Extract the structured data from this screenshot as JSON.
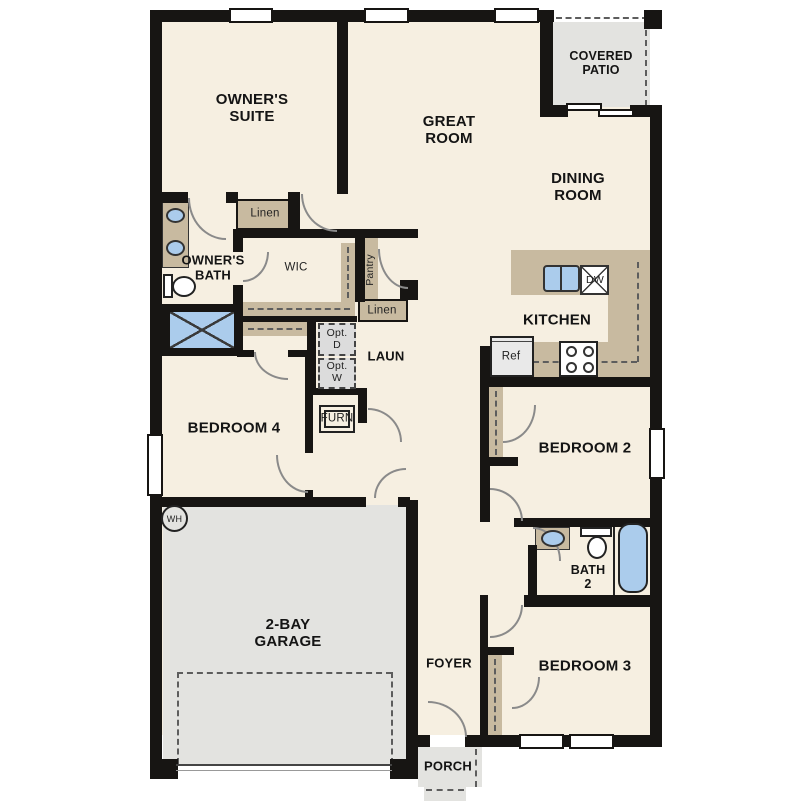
{
  "floorplan": {
    "title": "Single-story home floor plan",
    "colors": {
      "wall": "#171513",
      "interior_fill": "#f6efe1",
      "garage_patio_fill": "#e3e3e0",
      "cabinet_tan": "#c8baa0",
      "fixture_blue": "#abccec",
      "dashed_line": "#5d5d5d"
    },
    "labels": {
      "owners_suite": "OWNER'S\nSUITE",
      "great_room": "GREAT\nROOM",
      "dining_room": "DINING\nROOM",
      "covered_patio": "COVERED\nPATIO",
      "kitchen": "KITCHEN",
      "owners_bath": "OWNER'S\nBATH",
      "wic": "WIC",
      "linen_upper": "Linen",
      "linen_hall": "Linen",
      "pantry": "Pantry",
      "laundry": "LAUN",
      "opt_dryer": "Opt.\nD",
      "opt_washer": "Opt.\nW",
      "furnace": "FURN",
      "bedroom4": "BEDROOM 4",
      "bedroom2": "BEDROOM 2",
      "bedroom3": "BEDROOM 3",
      "bath2": "BATH\n2",
      "refrigerator": "Ref",
      "dishwasher": "DW",
      "water_heater": "WH",
      "garage": "2-BAY\nGARAGE",
      "foyer": "FOYER",
      "porch": "PORCH"
    }
  }
}
